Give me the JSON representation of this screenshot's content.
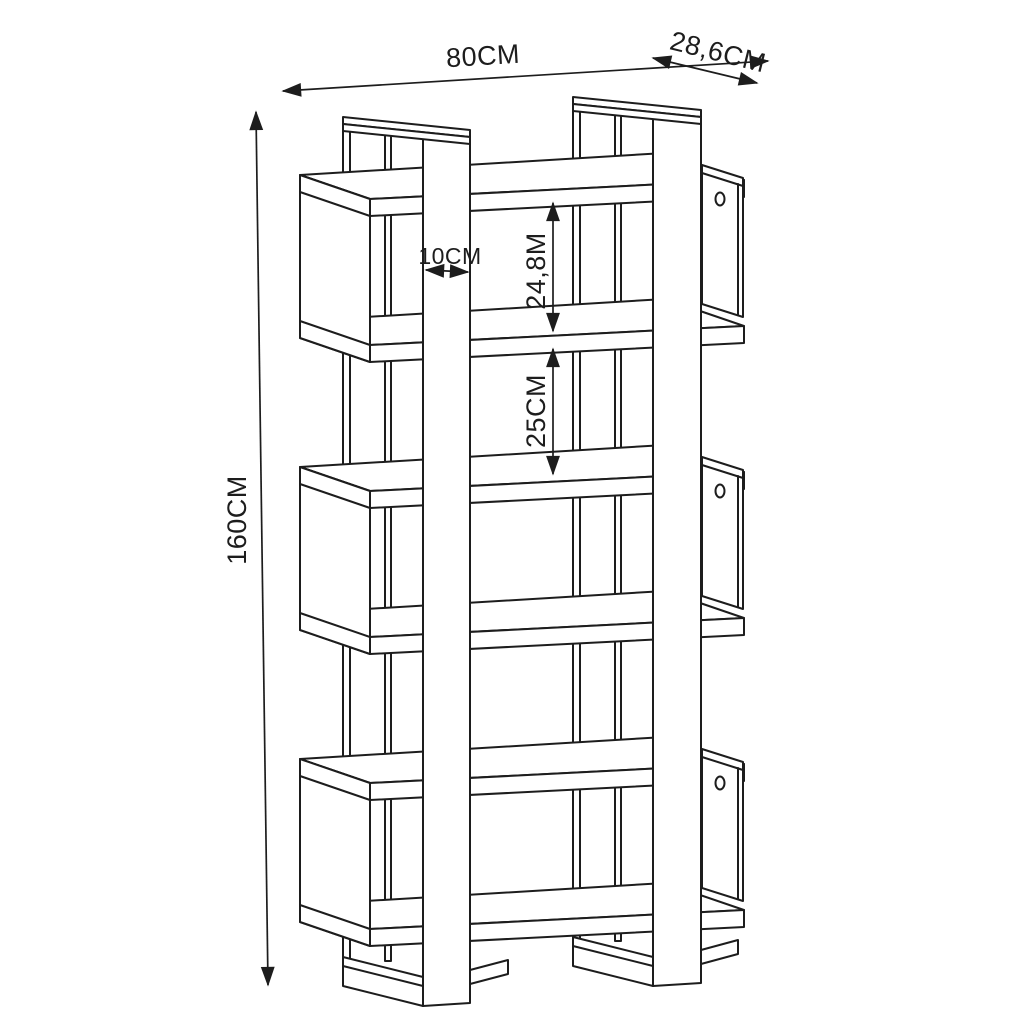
{
  "title": "Bookcase dimension drawing",
  "dimensions": {
    "width_label": "80CM",
    "depth_label": "28,6CM",
    "height_label": "160CM",
    "column_width_label": "10CM",
    "top_gap_label": "24,8M",
    "shelf_gap_label": "25CM"
  },
  "style": {
    "line_color": "#1d1d1d",
    "background": "#ffffff"
  }
}
